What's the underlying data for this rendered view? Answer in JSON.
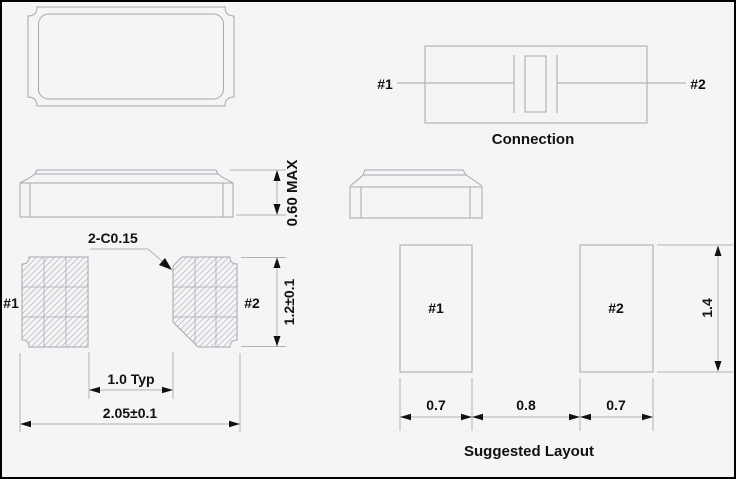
{
  "colors": {
    "background": "#f5f5f6",
    "outline": "#a4a8b0",
    "dimension": "#aeb2ba",
    "hatch": "#bcc0c8",
    "text": "#111111"
  },
  "views": {
    "connection": {
      "title": "Connection",
      "pin1": "#1",
      "pin2": "#2"
    },
    "side": {
      "height_dim": "0.60 MAX"
    },
    "bottom": {
      "chamfer_note": "2-C0.15",
      "pad1_label": "#1",
      "pad2_label": "#2",
      "width_dim": "2.05±0.1",
      "height_dim": "1.2±0.1",
      "pitch_dim": "1.0 Typ"
    },
    "layout": {
      "title": "Suggested Layout",
      "pad1_label": "#1",
      "pad2_label": "#2",
      "height_dim": "1.4",
      "left_pad_dim": "0.7",
      "gap_dim": "0.8",
      "right_pad_dim": "0.7"
    }
  }
}
